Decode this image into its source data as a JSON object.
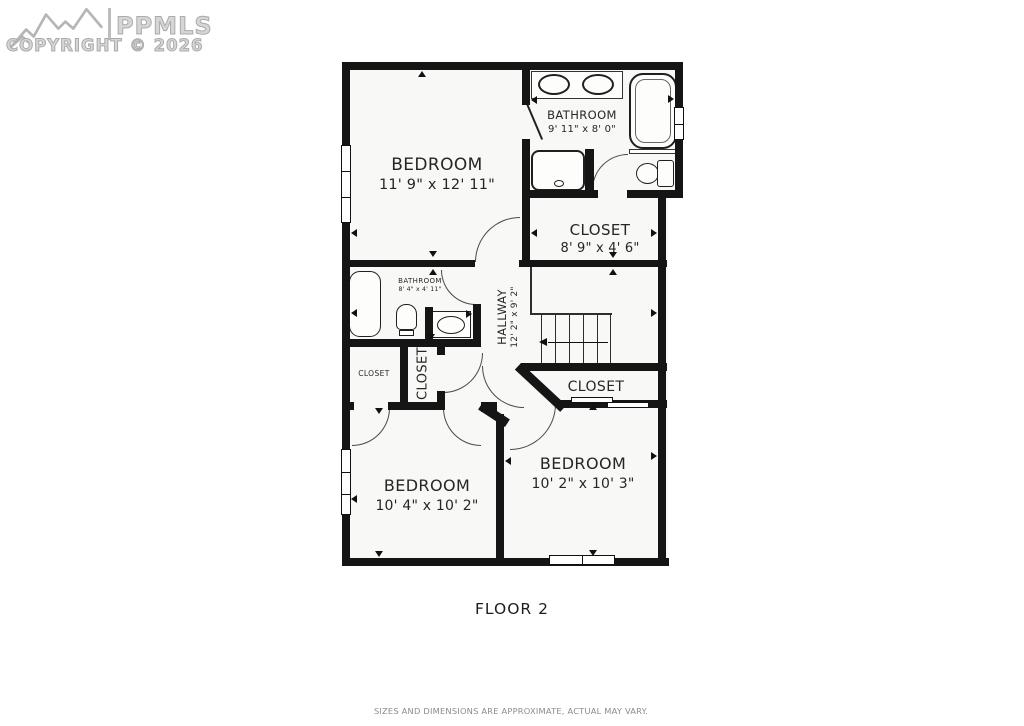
{
  "watermark": {
    "brand": "PPMLS",
    "copyright": "COPYRIGHT © 2026"
  },
  "plan": {
    "title": "FLOOR 2",
    "disclaimer": "SIZES AND DIMENSIONS ARE APPROXIMATE, ACTUAL MAY VARY.",
    "rooms": [
      {
        "name": "BEDROOM",
        "dims": "11' 9\" x 12' 11\""
      },
      {
        "name": "BATHROOM",
        "dims": "9' 11\" x 8' 0\""
      },
      {
        "name": "CLOSET",
        "dims": "8' 9\" x 4' 6\""
      },
      {
        "name": "BATHROOM",
        "dims": "8' 4\" x 4' 11\""
      },
      {
        "name": "HALLWAY",
        "dims": "12' 2\" x 9' 2\""
      },
      {
        "name": "CLOSET",
        "dims": ""
      },
      {
        "name": "CLOSET",
        "dims": ""
      },
      {
        "name": "CLOSET",
        "dims": ""
      },
      {
        "name": "BEDROOM",
        "dims": "10' 4\" x 10' 2\""
      },
      {
        "name": "BEDROOM",
        "dims": "10' 2\" x 10' 3\""
      }
    ]
  },
  "colors": {
    "wall": "#151515",
    "floor": "#f8f8f6",
    "text": "#262626",
    "watermark": "#c9c9c9",
    "disclaimer": "#8b8b8b"
  }
}
